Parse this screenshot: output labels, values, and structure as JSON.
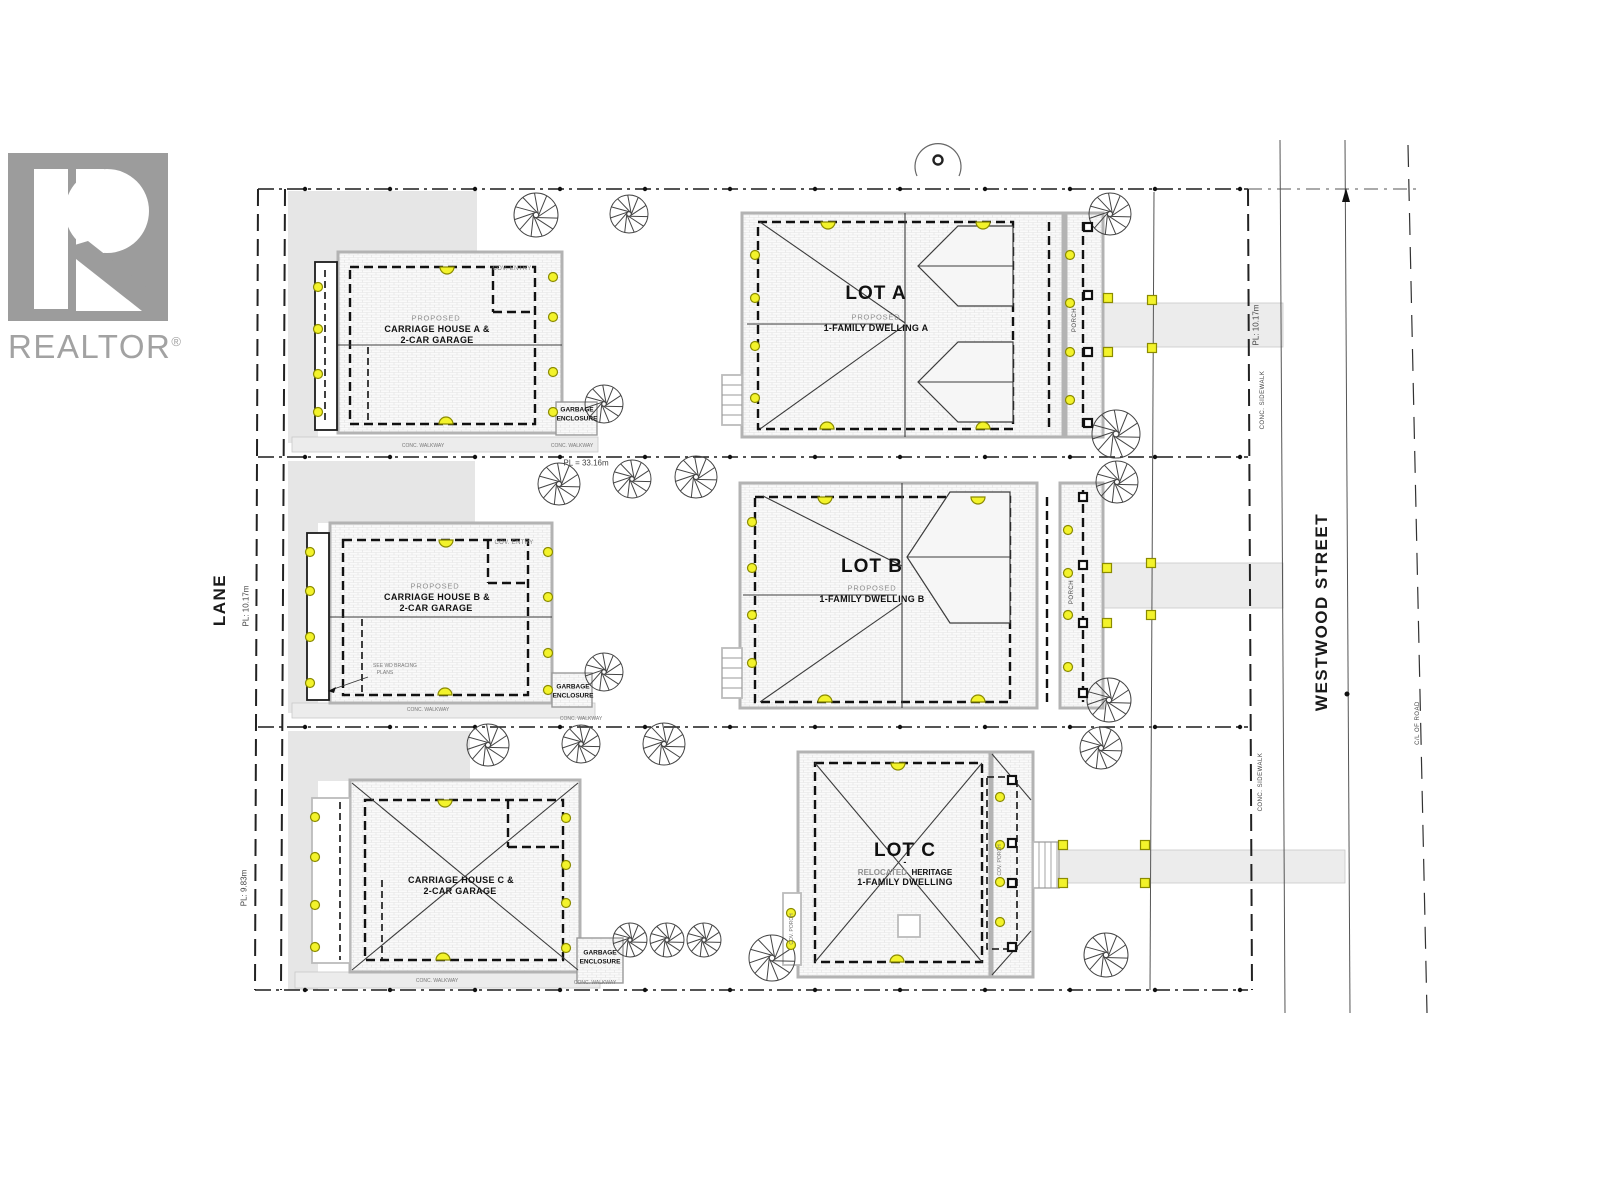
{
  "logo": {
    "brand": "REALTOR",
    "registered": "®"
  },
  "streets": {
    "lane": "LANE",
    "westwood": "WESTWOOD STREET",
    "conc_sidewalk": "CONC. SIDEWALK",
    "cl_of_road": "C/L OF ROAD"
  },
  "dimensions": {
    "pl_side": "PL: 10.17m",
    "pl_side_c": "PL: 9.83m",
    "pl_frontage": "PL = 33.16m"
  },
  "lots": {
    "a": {
      "title": "LOT A",
      "proposed": "PROPOSED",
      "dwelling": "1-FAMILY DWELLING A",
      "carriage_line1": "CARRIAGE HOUSE A &",
      "carriage_line2": "2-CAR GARAGE",
      "cov_entry": "COV. ENTRY",
      "porch": "PORCH"
    },
    "b": {
      "title": "LOT B",
      "proposed": "PROPOSED",
      "dwelling": "1-FAMILY DWELLING B",
      "carriage_line1": "CARRIAGE HOUSE B &",
      "carriage_line2": "2-CAR GARAGE",
      "cov_entry": "COV. ENTRY",
      "porch": "PORCH",
      "note_line1": "SEE WD BRACING",
      "note_line2": "PLANS"
    },
    "c": {
      "title": "LOT C",
      "separator": "-",
      "relocated": "RELOCATED",
      "heritage": "HERITAGE",
      "dwelling": "1-FAMILY DWELLING",
      "carriage_line1": "CARRIAGE HOUSE C &",
      "carriage_line2": "2-CAR GARAGE",
      "cov_porch": "COV. PORCH"
    }
  },
  "annotations": {
    "garbage_line1": "GARBAGE",
    "garbage_line2": "ENCLOSURE",
    "conc_walkway": "CONC. WALKWAY"
  },
  "colors": {
    "marker_yellow": "#f3f32b",
    "roof_gray": "#b3b3b3",
    "pad_gray": "#e6e6e6",
    "logo_gray": "#9c9c9c"
  }
}
